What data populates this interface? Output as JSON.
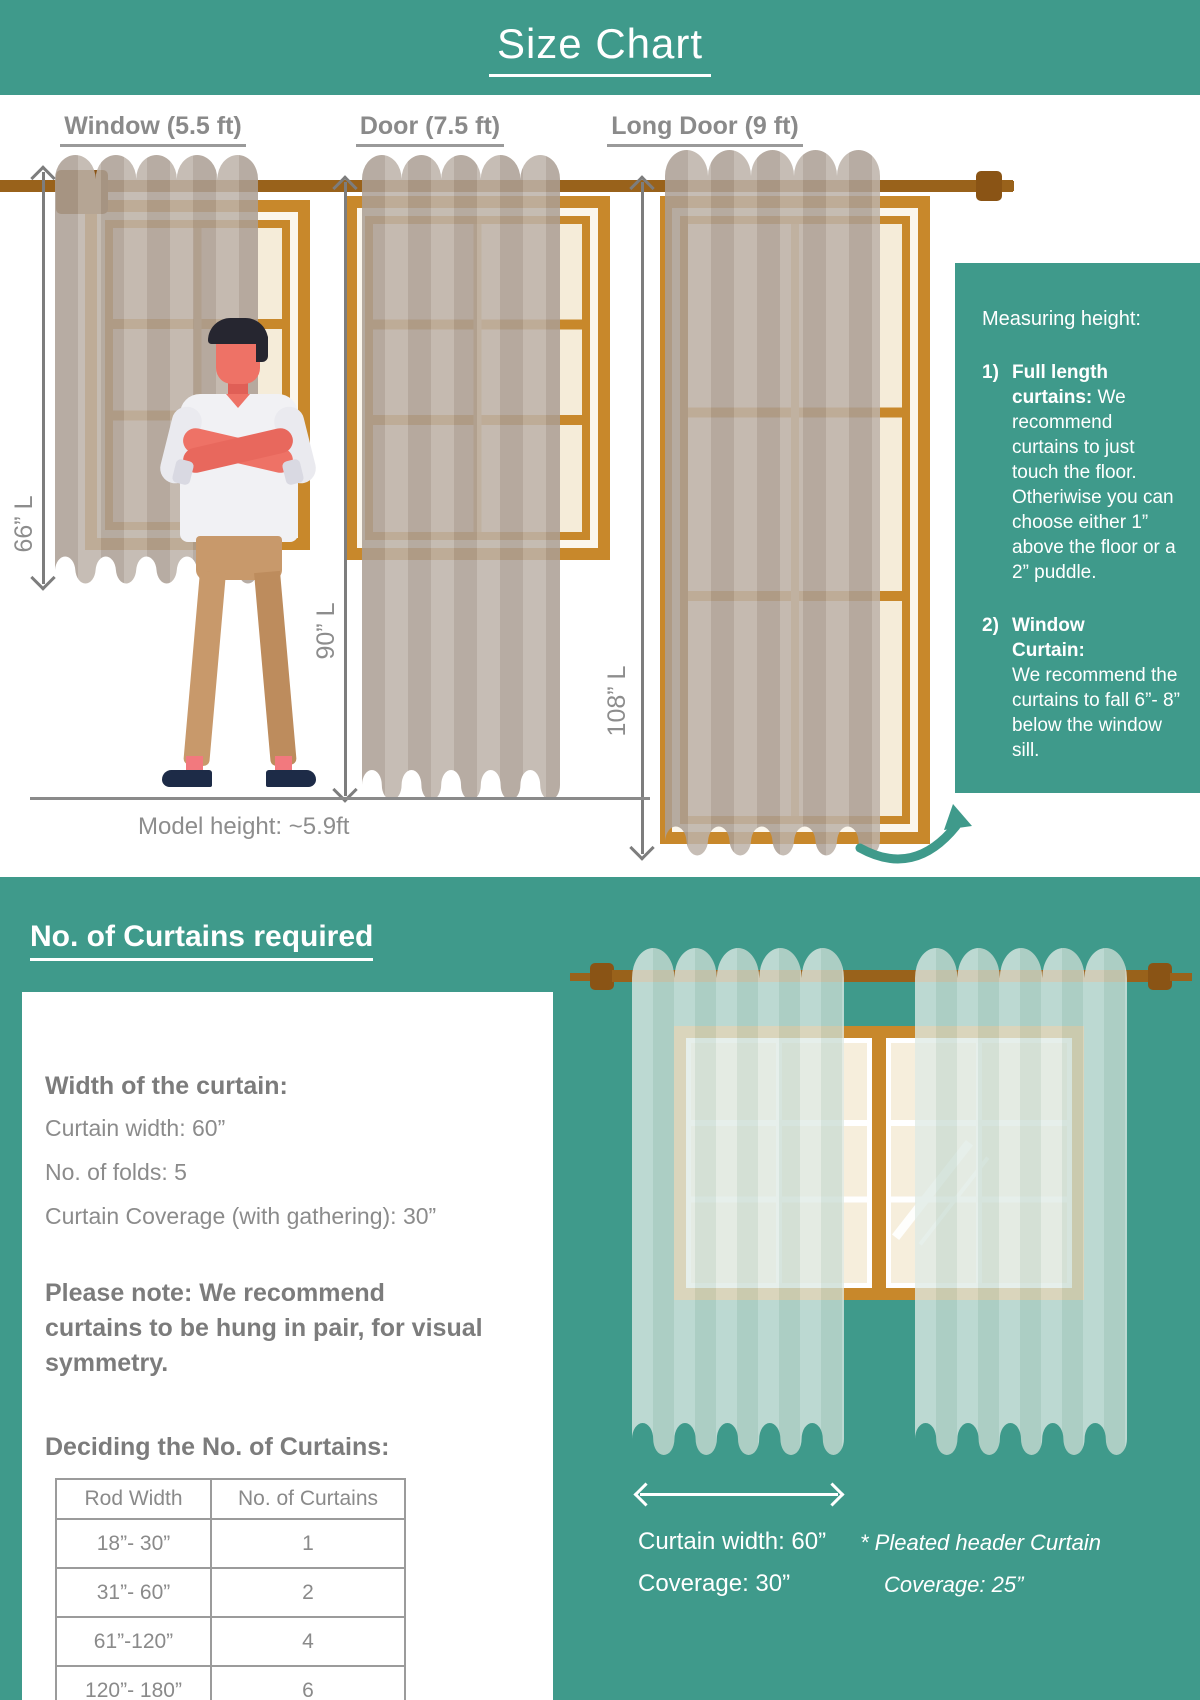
{
  "title": "Size Chart",
  "colors": {
    "teal": "#3F9A8B",
    "frame_orange": "#C8882B",
    "rod_brown": "#99621B",
    "curtain_taupe": "#B5A89D",
    "sheer_green": "#DCE9E2",
    "text_gray": "#8A8A8A"
  },
  "top_section": {
    "columns": [
      {
        "label": "Window (5.5 ft)",
        "length": "66” L"
      },
      {
        "label": "Door (7.5 ft)",
        "length": "90” L"
      },
      {
        "label": "Long Door (9 ft)",
        "length": "108” L"
      }
    ],
    "model_caption": "Model height: ~5.9ft",
    "measuring_box": {
      "title": "Measuring height:",
      "items": [
        {
          "num": "1)",
          "bold": "Full length curtains:",
          "text": "We recommend curtains to just touch the floor. Otheriwise you can choose either 1” above the floor or a 2” puddle."
        },
        {
          "num": "2)",
          "bold": "Window\nCurtain:",
          "text": "We recommend the curtains to fall 6”- 8” below the window sill."
        }
      ]
    }
  },
  "bottom_section": {
    "heading": "No. of Curtains required",
    "card": {
      "width_title": "Width of the curtain:",
      "specs": [
        "Curtain width: 60”",
        "No. of folds: 5",
        "Curtain Coverage (with gathering): 30”"
      ],
      "note": "Please note: We recommend curtains to be hung in pair, for visual symmetry.",
      "table_title": "Deciding the No. of Curtains:",
      "table": {
        "headers": [
          "Rod Width",
          "No. of Curtains"
        ],
        "rows": [
          [
            "18”- 30”",
            "1"
          ],
          [
            "31”- 60”",
            "2"
          ],
          [
            "61”-120”",
            "4"
          ],
          [
            "120”- 180”",
            "6"
          ]
        ]
      }
    },
    "illustration": {
      "width_label": "Curtain width: 60”",
      "coverage_label": "Coverage: 30”",
      "note_star": "* Pleated header Curtain",
      "note_line2": "Coverage: 25”"
    }
  }
}
